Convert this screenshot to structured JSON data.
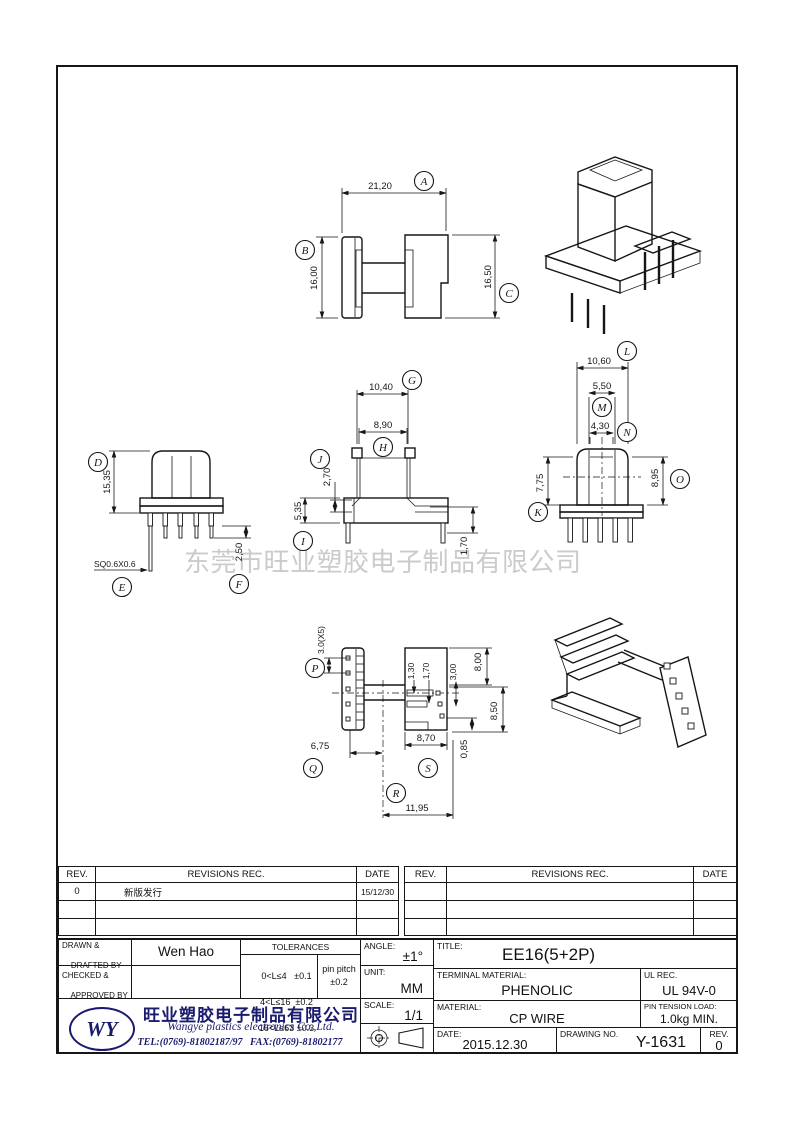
{
  "watermark": "东莞市旺业塑胶电子制品有限公司",
  "balloons": {
    "A": "A",
    "B": "B",
    "C": "C",
    "D": "D",
    "E": "E",
    "F": "F",
    "G": "G",
    "H": "H",
    "I": "I",
    "J": "J",
    "K": "K",
    "L": "L",
    "M": "M",
    "N": "N",
    "O": "O",
    "P": "P",
    "Q": "Q",
    "R": "R",
    "S": "S"
  },
  "dims": {
    "a": "21,20",
    "b": "16,00",
    "c": "16,50",
    "d": "15,35",
    "e": "SQ0.6X0.6",
    "f": "2,50",
    "g": "10,40",
    "h": "8,90",
    "i": "5,35",
    "j": "2,70",
    "side170": "1,70",
    "k": "7,75",
    "l": "10,60",
    "m": "5,50",
    "n": "4,30",
    "o": "8,95",
    "p": "3.0(X5)",
    "q": "6,75",
    "r": "11,95",
    "s": "8,70",
    "b130": "1,30",
    "b170": "1,70",
    "b300": "3,00",
    "b800": "8,00",
    "b850": "8,50",
    "b085": "0,85"
  },
  "revisions": {
    "left": {
      "rev_h": "REV.",
      "rec_h": "REVISIONS   REC.",
      "date_h": "DATE",
      "rows": [
        {
          "rev": "0",
          "rec": "新版发行",
          "date": "15/12/30"
        },
        {
          "rev": "",
          "rec": "",
          "date": ""
        },
        {
          "rev": "",
          "rec": "",
          "date": ""
        }
      ]
    },
    "right": {
      "rev_h": "REV.",
      "rec_h": "REVISIONS   REC.",
      "date_h": "DATE",
      "rows": [
        {
          "rev": "",
          "rec": "",
          "date": ""
        },
        {
          "rev": "",
          "rec": "",
          "date": ""
        },
        {
          "rev": "",
          "rec": "",
          "date": ""
        }
      ]
    }
  },
  "title_block": {
    "drawn_label_1": "DRAWN &",
    "drawn_label_2": "DRAFTED BY",
    "drawn_value": "Wen Hao",
    "checked_label_1": "CHECKED &",
    "checked_label_2": "APPROVED BY",
    "checked_value": "",
    "tol_title": "TOLERANCES",
    "tol_1": "0<L≤4   ±0.1",
    "tol_2": "4<L≤16  ±0.2",
    "tol_3": "16<L≤63 ±0.3",
    "pin_pitch_1": "pin pitch",
    "pin_pitch_2": "±0.2",
    "angle_label": "ANGLE:",
    "angle_value": "±1°",
    "unit_label": "UNIT:",
    "unit_value": "MM",
    "scale_label": "SCALE:",
    "scale_value": "1/1",
    "title_label": "TITLE:",
    "title_value": "EE16(5+2P)",
    "terminal_label": "TERMINAL MATERIAL:",
    "terminal_value": "PHENOLIC",
    "ul_label": "UL REC.",
    "ul_value": "UL 94V-0",
    "material_label": "MATERIAL:",
    "material_value": "CP WIRE",
    "pin_tension_label": "PIN TENSION LOAD:",
    "pin_tension_value": "1.0kg MIN.",
    "date_label": "DATE:",
    "date_value": "2015.12.30",
    "drawing_no_label": "DRAWING NO.",
    "drawing_no_value": "Y-1631",
    "rev_label": "REV.",
    "rev_value": "0"
  },
  "company": {
    "logo": "WY",
    "name_cn": "旺业塑胶电子制品有限公司",
    "name_en": "Wangye plastics electronics Co.,Ltd.",
    "tel": "TEL:(0769)-81802187/97   FAX:(0769)-81802177"
  }
}
